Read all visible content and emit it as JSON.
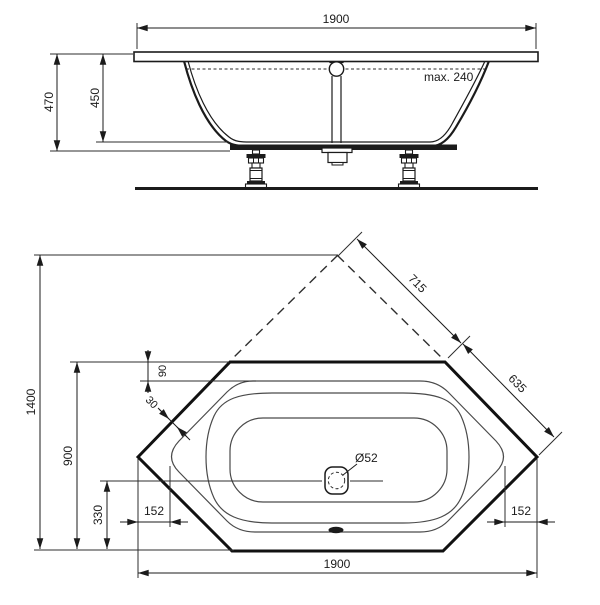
{
  "side_view": {
    "dim_width": "1900",
    "dim_height_total": "470",
    "dim_height_inner": "450",
    "note_max_fill": "max. 240"
  },
  "plan_view": {
    "dim_overall_length": "1900",
    "dim_overall_depth": "1400",
    "dim_width": "900",
    "dim_drain_from_edge": "330",
    "dim_corner_left": "152",
    "dim_corner_right": "152",
    "dim_diagonal_upper": "715",
    "dim_diagonal_lower": "635",
    "dim_rim_width": "90",
    "dim_rim_edge_offset": "30",
    "dim_drain_diameter": "Ø52"
  },
  "colors": {
    "ink": "#1b1b1b",
    "thin_line": "#4a4a4a",
    "background": "#ffffff"
  }
}
